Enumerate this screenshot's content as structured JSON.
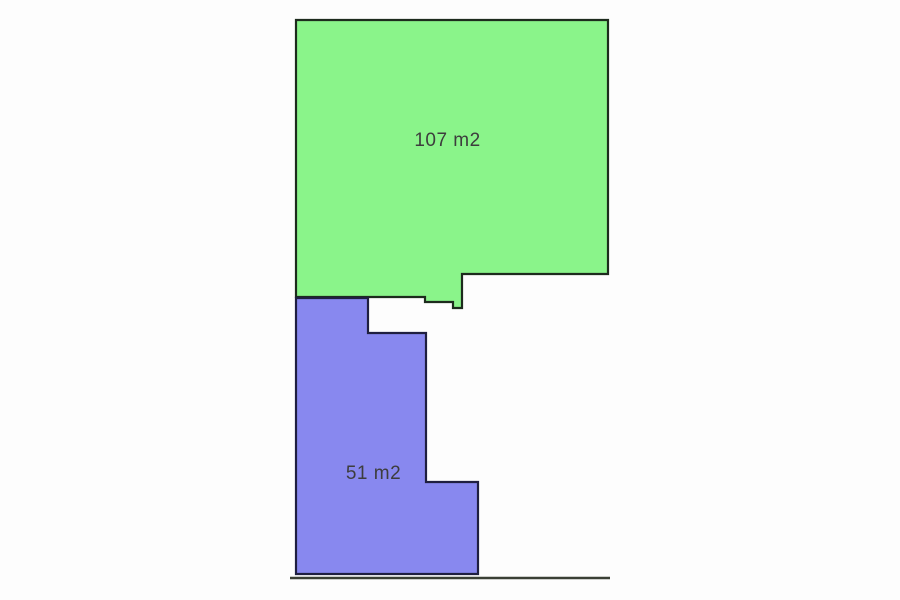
{
  "title": "Parcel area plan",
  "canvas": {
    "width": 900,
    "height": 600,
    "background": "#fdfdfd"
  },
  "diagram": {
    "type": "floor-plan",
    "units": "m2",
    "label_color": "#3d3d3d",
    "label_font_size": 19,
    "parcels": [
      {
        "id": "parcel-green",
        "label": "107 m2",
        "area_value": 107,
        "fill": "#8af48a",
        "stroke": "#1d2b1d",
        "stroke_width": 2.2,
        "points": "296,20 608,20 608,274 462,274 462,308 453,308 453,302 425,302 425,297 296,297",
        "label_x": 447.5,
        "label_y": 146
      },
      {
        "id": "parcel-blue",
        "label": "51 m2",
        "area_value": 51,
        "fill": "#8888ef",
        "stroke": "#1f1f40",
        "stroke_width": 2.2,
        "points": "296,298 368,298 368,333 426,333 426,482 478,482 478,574 296,574",
        "label_x": 373.5,
        "label_y": 479
      }
    ],
    "baseline": {
      "x1": 290,
      "y1": 578,
      "x2": 610,
      "y2": 578,
      "color": "#3a3f35",
      "width": 2.5
    }
  }
}
